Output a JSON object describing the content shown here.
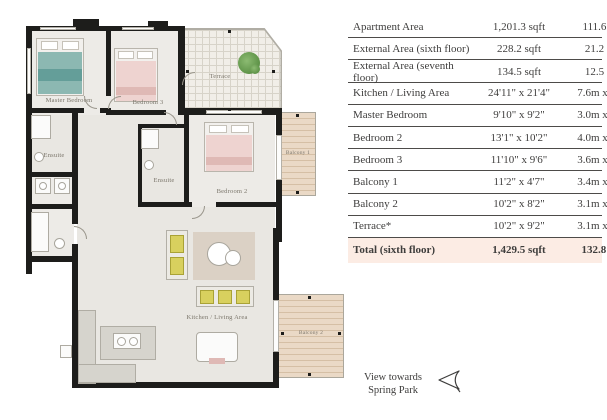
{
  "table": {
    "rows": [
      {
        "label": "Apartment Area",
        "imperial": "1,201.3 sqft",
        "metric": "111.6 sqm"
      },
      {
        "label": "External Area (sixth floor)",
        "imperial": "228.2 sqft",
        "metric": "21.2 sqm"
      },
      {
        "label": "External Area (seventh floor)",
        "imperial": "134.5 sqft",
        "metric": "12.5 sqm"
      },
      {
        "label": "Kitchen / Living Area",
        "imperial": "24'11\" x 21'4\"",
        "metric": "7.6m x 6.5m"
      },
      {
        "label": "Master Bedroom",
        "imperial": "9'10\" x 9'2\"",
        "metric": "3.0m x 2.8m"
      },
      {
        "label": "Bedroom 2",
        "imperial": "13'1\" x 10'2\"",
        "metric": "4.0m x 3.1m"
      },
      {
        "label": "Bedroom 3",
        "imperial": "11'10\" x 9'6\"",
        "metric": "3.6m x 2.9m"
      },
      {
        "label": "Balcony 1",
        "imperial": "11'2\" x 4'7\"",
        "metric": "3.4m x 1.4m"
      },
      {
        "label": "Balcony 2",
        "imperial": "10'2\" x 8'2\"",
        "metric": "3.1m x 2.5m"
      },
      {
        "label": "Terrace*",
        "imperial": "10'2\" x 9'2\"",
        "metric": "3.1m x 2.8m"
      },
      {
        "label": "Total (sixth floor)",
        "imperial": "1,429.5 sqft",
        "metric": "132.8 sqm"
      }
    ],
    "highlight_color": "#fcece4",
    "rule_color": "#4d4b49"
  },
  "plan": {
    "labels": {
      "master_bedroom": "Master Bedroom",
      "bedroom_3": "Bedroom 3",
      "bedroom_2": "Bedroom 2",
      "ensuite_1": "Ensuite",
      "ensuite_2": "Ensuite",
      "terrace": "Terrace",
      "kitchen_living": "Kitchen / Living Area",
      "balcony_1": "Balcony 1",
      "balcony_2": "Balcony 2"
    },
    "colors": {
      "wall": "#1d1d1b",
      "floor": "#e9e7e2",
      "teal_bed": "#8cb8b2",
      "pink_bed": "#eed3d0",
      "wood_deck": "#ead9c6",
      "plant": "#5d9247",
      "cushion_yellow": "#d8d05e"
    }
  },
  "view_note": {
    "line1": "View towards",
    "line2": "Spring Park"
  }
}
